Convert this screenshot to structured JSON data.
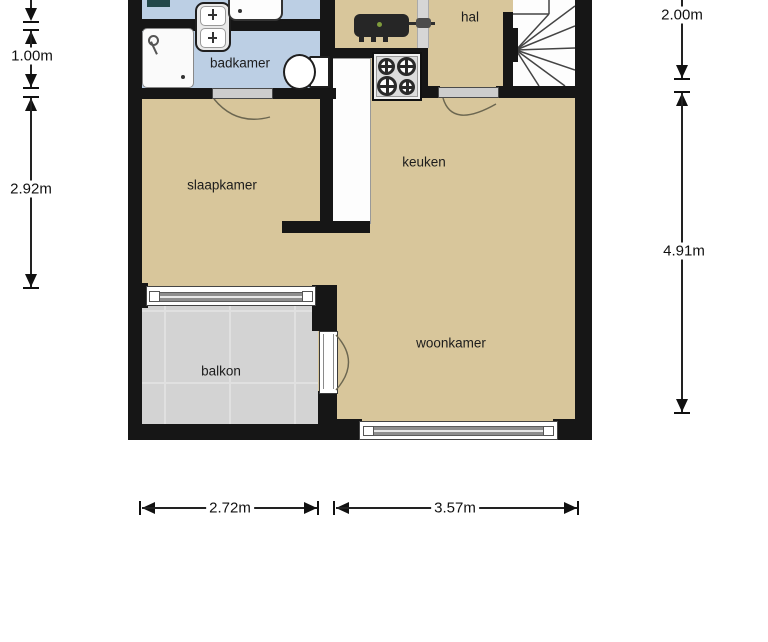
{
  "plan_title": "apartment floor plan",
  "rooms": {
    "badkamer": "badkamer",
    "hal": "hal",
    "slaapkamer": "slaapkamer",
    "keuken": "keuken",
    "woonkamer": "woonkamer",
    "balkon": "balkon"
  },
  "dimensions": {
    "left_upper": "1.00m",
    "left_lower": "2.92m",
    "right_upper": "2.00m",
    "right_lower": "4.91m",
    "bottom_left": "2.72m",
    "bottom_right": "3.57m"
  },
  "fixtures": [
    "shower",
    "double-washbasin",
    "bathtub",
    "toilet",
    "boiler",
    "stove",
    "kitchen-counter",
    "staircase",
    "bedroom-door",
    "hall-door",
    "balcony-door",
    "bedroom-window",
    "livingroom-window",
    "balcony-tiles"
  ],
  "colors": {
    "wall": "#161616",
    "room": "#d8c69b",
    "bath": "#bccfe4",
    "balcony": "#d3d3d3"
  }
}
